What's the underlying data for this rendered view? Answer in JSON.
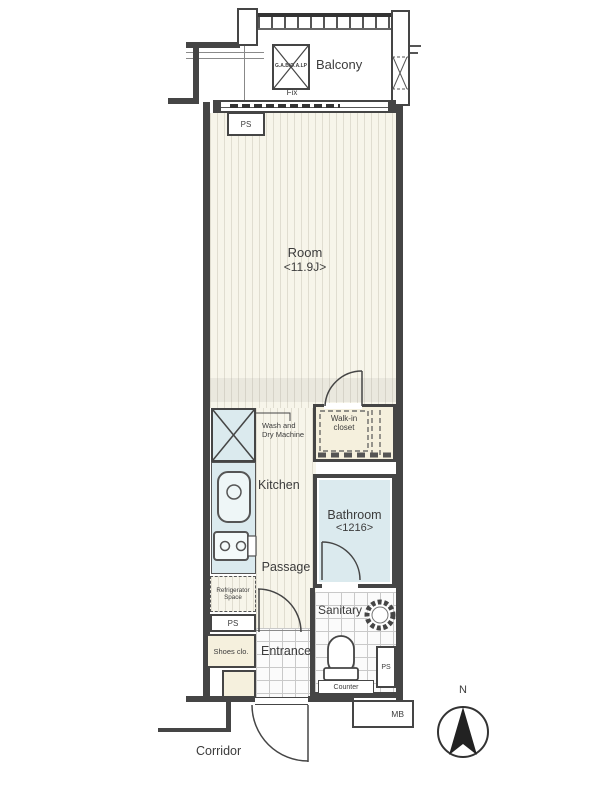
{
  "plan": {
    "balcony": {
      "label": "Balcony",
      "hatch_label": "G.A.B/O.A.LP",
      "window_label": "Fix"
    },
    "room": {
      "label": "Room",
      "size": "<11.9J>"
    },
    "walk_in_closet": {
      "line1": "Walk-in",
      "line2": "closet"
    },
    "laundry": {
      "line1": "Wash and",
      "line2": "Dry Machine"
    },
    "kitchen": {
      "label": "Kitchen"
    },
    "bathroom": {
      "label": "Bathroom",
      "size": "<1216>"
    },
    "passage": {
      "label": "Passage"
    },
    "refrigerator": {
      "line1": "Refrigerator",
      "line2": "Space"
    },
    "sanitary": {
      "label": "Sanitary",
      "counter": "Counter"
    },
    "entrance": {
      "label": "Entrance"
    },
    "shoes_closet": {
      "label": "Shoes clo."
    },
    "corridor": {
      "label": "Corridor"
    },
    "meter_box": {
      "label": "MB"
    },
    "pipe_space": {
      "top": "PS",
      "lower": "PS",
      "sanitary": "PS"
    },
    "compass": {
      "north": "N"
    },
    "colors": {
      "wall": "#454545",
      "wet_area": "#dbeaee",
      "closet_fill": "#f5f0dd",
      "floor": "#f7f5ea"
    }
  }
}
